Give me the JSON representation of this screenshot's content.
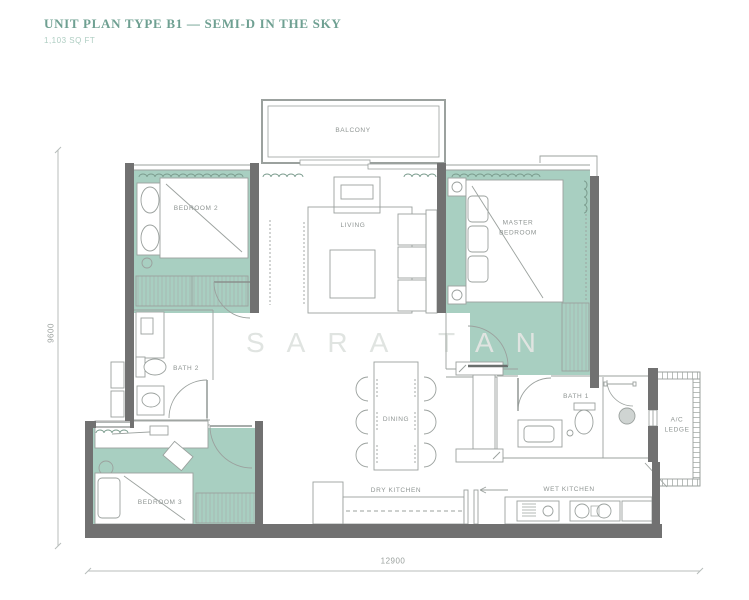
{
  "header": {
    "title": "UNIT PLAN TYPE B1 — SEMI-D IN THE SKY",
    "area": "1,103 SQ FT"
  },
  "watermark": "SARA TAN",
  "dimensions": {
    "width": "12900",
    "height": "9600"
  },
  "rooms": {
    "balcony": "BALCONY",
    "living": "LIVING",
    "bedroom2": "BEDROOM 2",
    "master": "MASTER BEDROOM",
    "bath2": "BATH 2",
    "bedroom3": "BEDROOM 3",
    "dining": "DINING",
    "dry_kitchen": "DRY KITCHEN",
    "wet_kitchen": "WET KITCHEN",
    "bath1": "BATH 1",
    "ac_ledge": "A/C LEDGE"
  },
  "colors": {
    "accent": "#6FA092",
    "floor_fill": "#A8CFC1",
    "wall_fill": "#717171",
    "line": "#9BA19E",
    "watermark": "#E0E4E1"
  }
}
